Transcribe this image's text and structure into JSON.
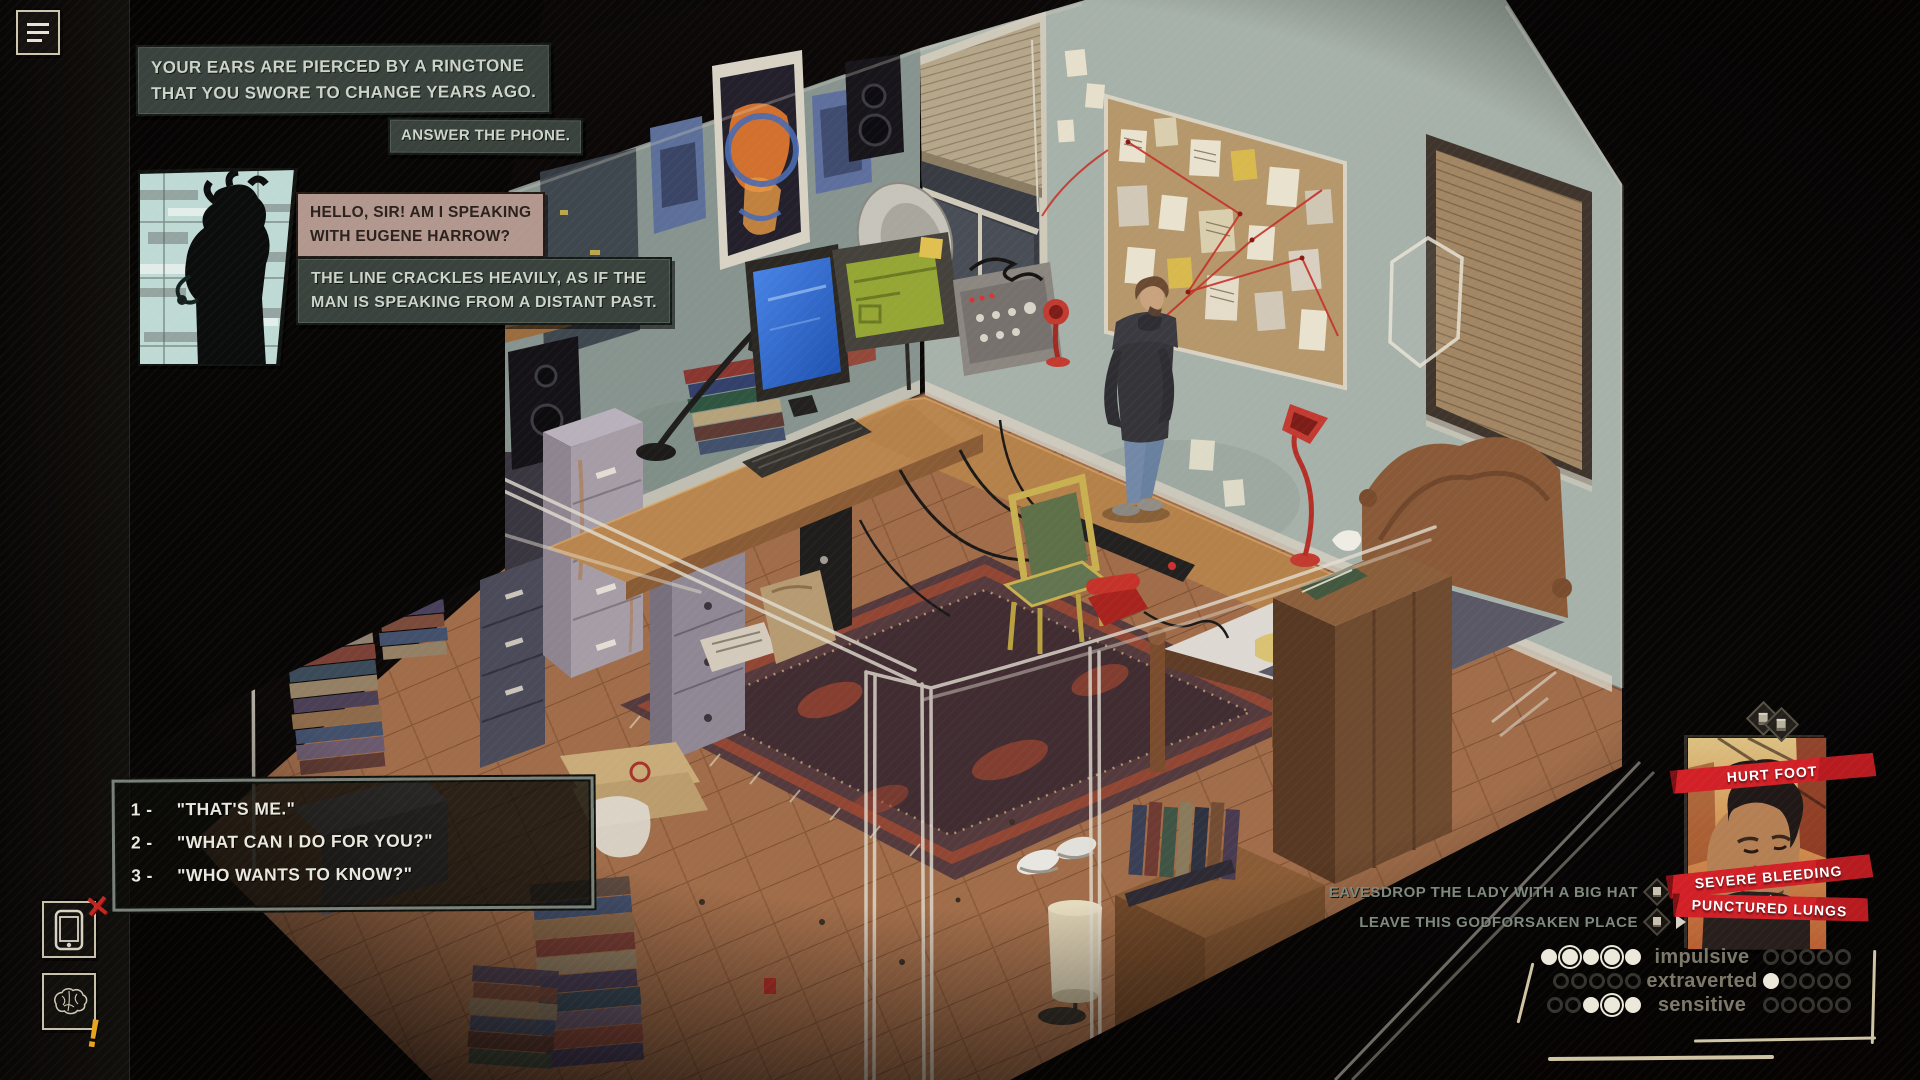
{
  "dialogue": {
    "narration_ringtone": "YOUR EARS ARE PIERCED BY A RINGTONE\nTHAT YOU SWORE TO CHANGE YEARS AGO.",
    "action_prompt": "ANSWER THE PHONE.",
    "caller_speech": "HELLO, SIR! AM I SPEAKING\nWITH EUGENE HARROW?",
    "narration_line": "THE LINE CRACKLES HEAVILY, AS IF THE\nMAN IS SPEAKING FROM A DISTANT PAST.",
    "options": [
      {
        "num": "1 -",
        "text": "\"THAT'S ME.\""
      },
      {
        "num": "2 -",
        "text": "\"WHAT CAN I DO FOR YOU?\""
      },
      {
        "num": "3 -",
        "text": "\"WHO WANTS TO KNOW?\""
      }
    ]
  },
  "status": {
    "effects": [
      "HURT FOOT",
      "SEVERE BLEEDING",
      "PUNCTURED LUNGS"
    ]
  },
  "world_actions": [
    {
      "label": "EAVESDROP THE LADY WITH A BIG HAT"
    },
    {
      "label": "LEAVE THIS GODFORSAKEN PLACE"
    }
  ],
  "traits": [
    {
      "label": "impulsive",
      "left": [
        "filled",
        "ring",
        "filled",
        "ring",
        "filled"
      ],
      "right": [
        "empty",
        "empty",
        "empty",
        "empty",
        "empty"
      ]
    },
    {
      "label": "extraverted",
      "left": [
        "empty",
        "empty",
        "empty",
        "empty",
        "empty"
      ],
      "right": [
        "filled",
        "empty",
        "empty",
        "empty",
        "empty"
      ]
    },
    {
      "label": "sensitive",
      "left": [
        "empty",
        "empty",
        "filled",
        "ring",
        "filled"
      ],
      "right": [
        "empty",
        "empty",
        "empty",
        "empty",
        "empty"
      ]
    }
  ],
  "icons": {
    "menu": "hamburger-menu-icon",
    "phone_tool": "smartphone-icon",
    "phone_tool_badge": "red-x-icon",
    "brain_tool": "brain-icon",
    "brain_tool_badge": "yellow-exclamation-icon",
    "action_marker": "diamond-card-icon",
    "action_pointer": "triangle-pointer-icon",
    "portrait_marker": "double-diamond-icon"
  },
  "colors": {
    "narration_bg": "#39423c",
    "narration_text": "#ccd3c8",
    "speech_bg": "#b1978d",
    "speech_text": "#2a211c",
    "banner_red": "#d22027",
    "action_text": "#7e897d",
    "trait_label": "#7c7869",
    "dot_fill": "#ece8da",
    "dot_empty_ring": "#35332d",
    "sketch_line": "#cfc4a4"
  }
}
